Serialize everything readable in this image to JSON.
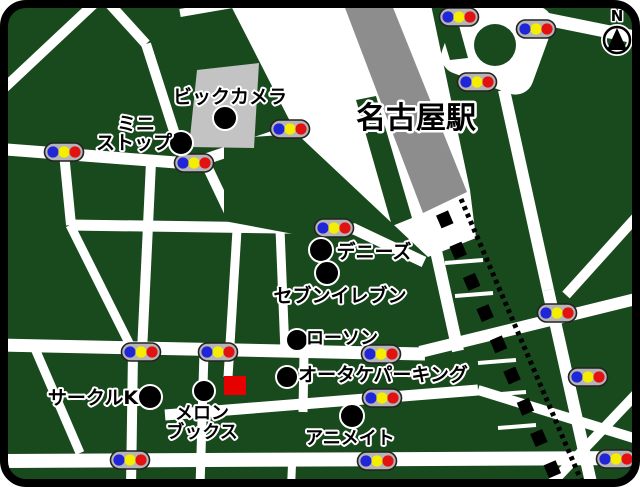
{
  "compass": {
    "label": "N"
  },
  "station": {
    "label": "名古屋駅"
  },
  "pois": [
    {
      "id": "bic-camera",
      "label": "ビックカメラ"
    },
    {
      "id": "ministop",
      "label": "ミニストップ",
      "line1": "ミニ",
      "line2": "ストップ"
    },
    {
      "id": "dennys",
      "label": "デニーズ"
    },
    {
      "id": "seven-eleven",
      "label": "セブンイレブン"
    },
    {
      "id": "lawson",
      "label": "ローソン"
    },
    {
      "id": "otake-parking",
      "label": "オータケパーキング"
    },
    {
      "id": "circle-k",
      "label": "サークルK"
    },
    {
      "id": "melon-books",
      "label": "メロンブックス",
      "line1": "メロン",
      "line2": "ブックス"
    },
    {
      "id": "animate",
      "label": "アニメイト"
    }
  ],
  "traffic_light": {
    "icon": "traffic-light-icon",
    "count": 16,
    "colors": {
      "blue": "#2026d8",
      "yellow": "#f6ee00",
      "red": "#e21212",
      "body": "#b5b5b5"
    }
  },
  "destination_marker": {
    "icon": "red-square-icon",
    "color": "#e60000"
  },
  "icons": {
    "compass": "north-compass-icon",
    "poi_dot": "black-dot-icon"
  },
  "colors": {
    "land": "#194a1d",
    "road": "#ffffff",
    "station_building": "#8d8d8d",
    "bic_building": "#c3c3c3",
    "border": "#000000"
  }
}
